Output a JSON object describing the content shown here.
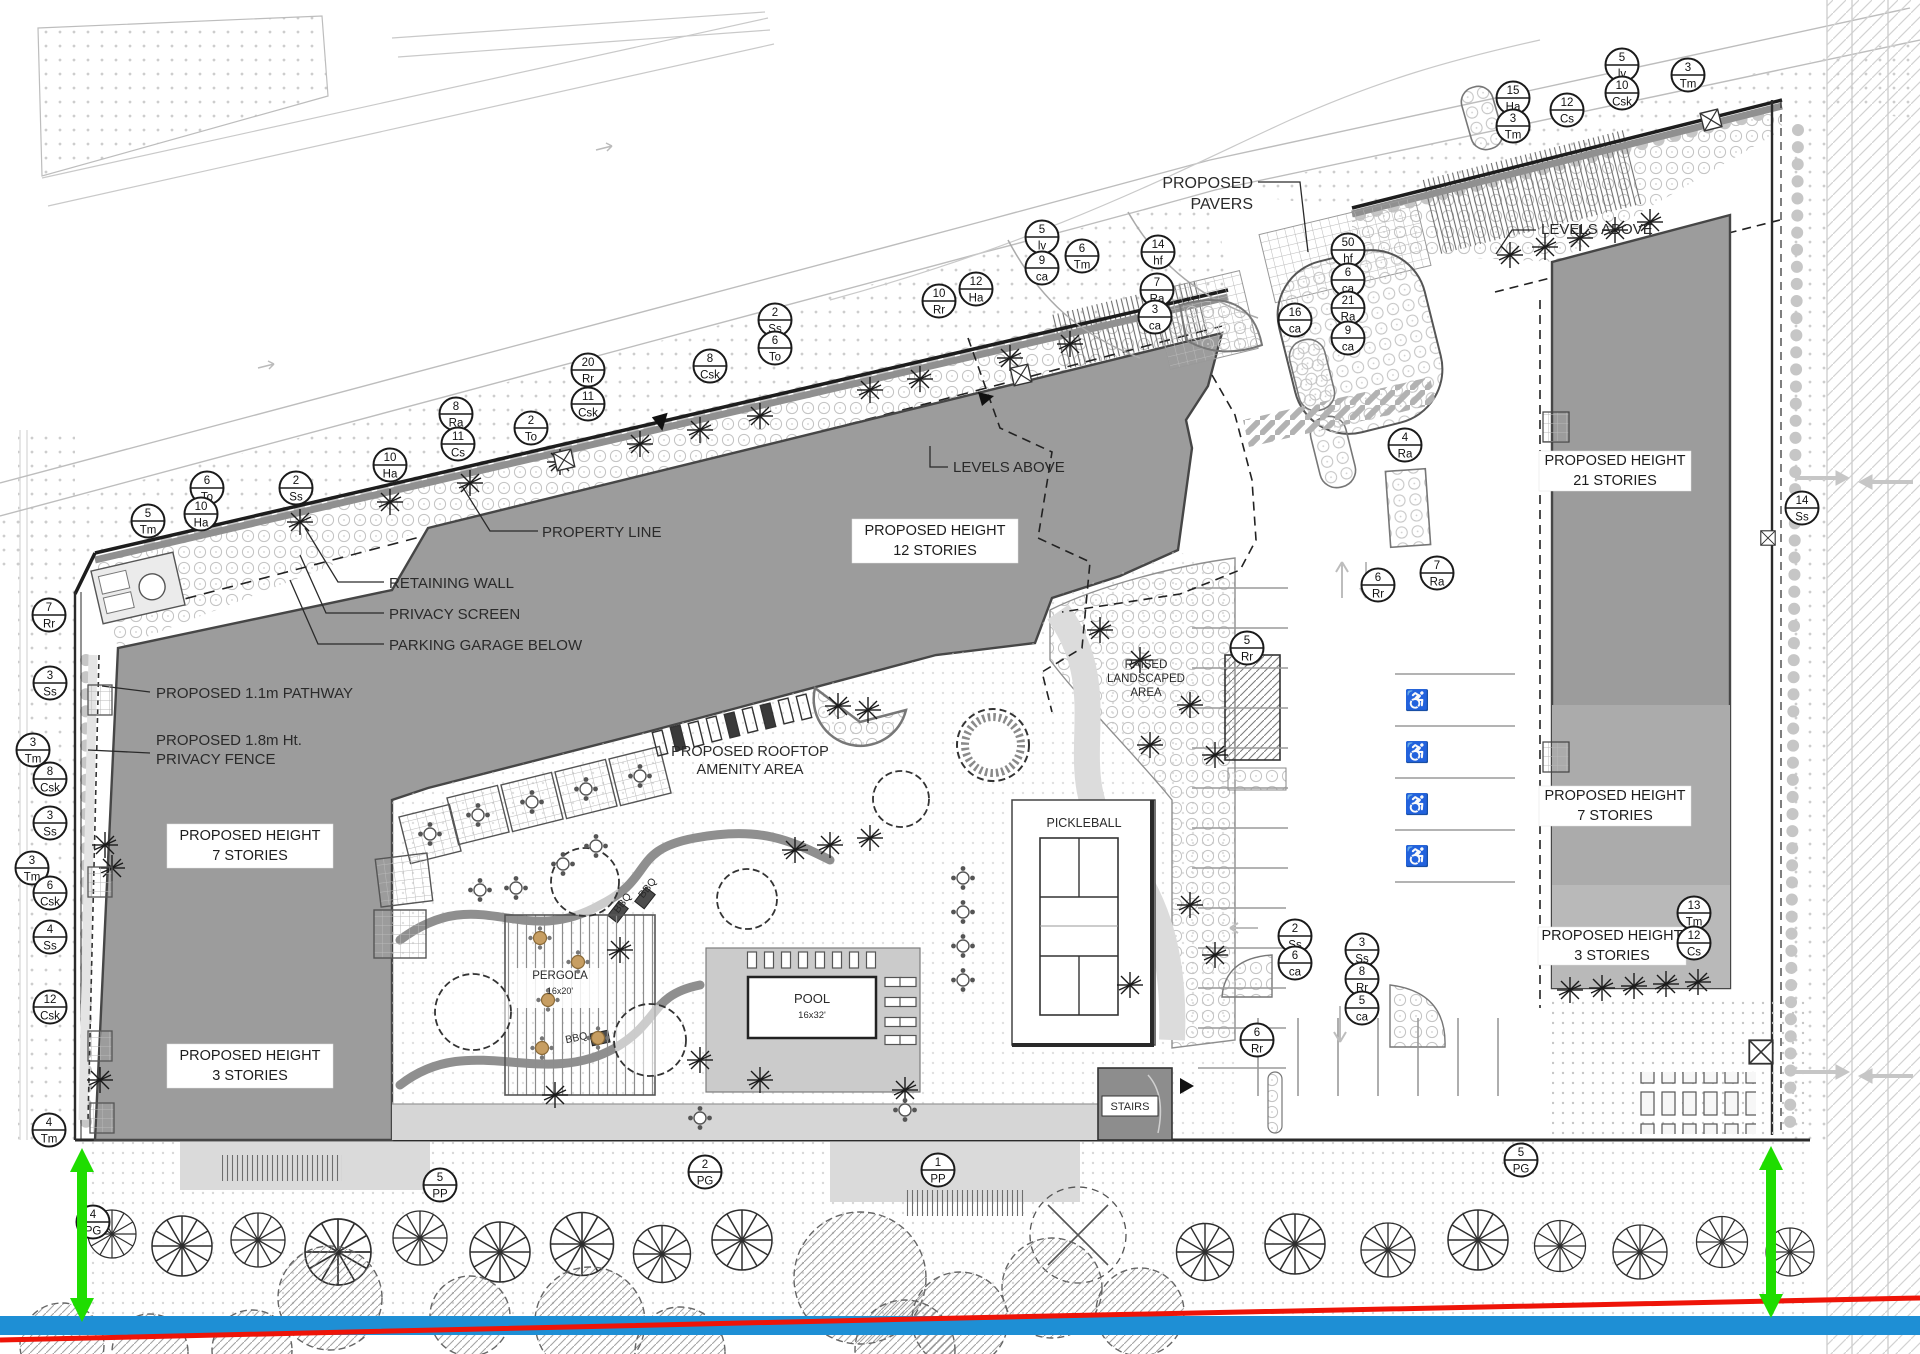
{
  "drawing": {
    "type": "landscape-architecture site plan",
    "colors": {
      "building_dark": "#9c9c9c",
      "building_mid": "#ababab",
      "building_light": "#b9b9b9",
      "deck_gray": "#cbcbcb",
      "walk_gray": "#d6d6d6",
      "line_dark": "#2a2a2a",
      "section_green": "#1fdd00",
      "section_red": "#ee1408",
      "section_blue": "#1e8fd5"
    },
    "labels": [
      {
        "text": "PROPOSED",
        "x": 1253,
        "y": 188,
        "size": 16,
        "anchor": "end"
      },
      {
        "text": "PAVERS",
        "x": 1253,
        "y": 209,
        "size": 16,
        "anchor": "end"
      },
      {
        "text": "LEVELS ABOVE",
        "x": 953,
        "y": 472,
        "size": 15,
        "anchor": "start"
      },
      {
        "text": "LEVELS ABOVE",
        "x": 1541,
        "y": 234,
        "size": 15,
        "anchor": "start"
      },
      {
        "text": "PROPERTY LINE",
        "x": 542,
        "y": 537,
        "size": 15,
        "anchor": "start"
      },
      {
        "text": "RETAINING WALL",
        "x": 389,
        "y": 588,
        "size": 15,
        "anchor": "start"
      },
      {
        "text": "PRIVACY SCREEN",
        "x": 389,
        "y": 619,
        "size": 15,
        "anchor": "start"
      },
      {
        "text": "PARKING GARAGE BELOW",
        "x": 389,
        "y": 650,
        "size": 15,
        "anchor": "start"
      },
      {
        "text": "PROPOSED 1.1m PATHWAY",
        "x": 156,
        "y": 698,
        "size": 15,
        "anchor": "start"
      },
      {
        "text": "PROPOSED 1.8m Ht.",
        "x": 156,
        "y": 745,
        "size": 15,
        "anchor": "start"
      },
      {
        "text": "PRIVACY FENCE",
        "x": 156,
        "y": 764,
        "size": 15,
        "anchor": "start"
      },
      {
        "text": "PROPOSED ROOFTOP",
        "x": 750,
        "y": 756,
        "size": 14.5,
        "anchor": "middle"
      },
      {
        "text": "AMENITY AREA",
        "x": 750,
        "y": 774,
        "size": 14.5,
        "anchor": "middle"
      },
      {
        "text": "RAISED",
        "x": 1146,
        "y": 668,
        "size": 11.5,
        "anchor": "middle"
      },
      {
        "text": "LANDSCAPED",
        "x": 1146,
        "y": 682,
        "size": 11.5,
        "anchor": "middle"
      },
      {
        "text": "AREA",
        "x": 1146,
        "y": 696,
        "size": 11.5,
        "anchor": "middle"
      },
      {
        "text": "PICKLEBALL",
        "x": 1084,
        "y": 827,
        "size": 12.5,
        "anchor": "middle"
      },
      {
        "text": "POOL",
        "x": 812,
        "y": 1003,
        "size": 13,
        "anchor": "middle"
      },
      {
        "text": "16x32'",
        "x": 812,
        "y": 1018,
        "size": 9.5,
        "anchor": "middle"
      },
      {
        "text": "PERGOLA",
        "x": 560,
        "y": 979,
        "size": 11.5,
        "anchor": "middle"
      },
      {
        "text": "16x20'",
        "x": 560,
        "y": 994,
        "size": 9,
        "anchor": "middle"
      },
      {
        "text": "STAIRS",
        "x": 1130,
        "y": 1110,
        "size": 11,
        "anchor": "middle"
      },
      {
        "text": "BBQ",
        "x": 625,
        "y": 905,
        "size": 10.5,
        "anchor": "middle",
        "rot": -52
      },
      {
        "text": "BBQ",
        "x": 650,
        "y": 890,
        "size": 10.5,
        "anchor": "middle",
        "rot": -52
      },
      {
        "text": "BBQ",
        "x": 577,
        "y": 1041,
        "size": 10.5,
        "anchor": "middle",
        "rot": -12
      }
    ],
    "height_boxes": [
      {
        "l1": "PROPOSED HEIGHT",
        "l2": "12 STORIES",
        "x": 935,
        "y": 541,
        "nx": -83,
        "ny": -22,
        "w": 166,
        "h": 44
      },
      {
        "l1": "PROPOSED HEIGHT",
        "l2": "7 STORIES",
        "x": 250,
        "y": 846,
        "nx": -83,
        "ny": -22,
        "w": 166,
        "h": 44
      },
      {
        "l1": "PROPOSED HEIGHT",
        "l2": "3 STORIES",
        "x": 250,
        "y": 1066,
        "nx": -83,
        "ny": -22,
        "w": 166,
        "h": 44
      },
      {
        "l1": "PROPOSED HEIGHT",
        "l2": "21 STORIES",
        "x": 1615,
        "y": 471,
        "nx": -76,
        "ny": -20,
        "w": 152,
        "h": 40
      },
      {
        "l1": "PROPOSED HEIGHT",
        "l2": "7 STORIES",
        "x": 1615,
        "y": 806,
        "nx": -76,
        "ny": -20,
        "w": 152,
        "h": 40
      },
      {
        "l1": "PROPOSED HEIGHT",
        "l2": "3 STORIES",
        "x": 1612,
        "y": 946,
        "nx": -74,
        "ny": -19,
        "w": 148,
        "h": 38
      }
    ],
    "plant_tags": [
      {
        "q": "6",
        "c": "To",
        "x": 207,
        "y": 488
      },
      {
        "q": "10",
        "c": "Ha",
        "x": 201,
        "y": 514
      },
      {
        "q": "5",
        "c": "Tm",
        "x": 148,
        "y": 521
      },
      {
        "q": "2",
        "c": "Ss",
        "x": 296,
        "y": 488
      },
      {
        "q": "10",
        "c": "Ha",
        "x": 390,
        "y": 465
      },
      {
        "q": "8",
        "c": "Ra",
        "x": 456,
        "y": 414
      },
      {
        "q": "11",
        "c": "Cs",
        "x": 458,
        "y": 444
      },
      {
        "q": "2",
        "c": "To",
        "x": 531,
        "y": 428
      },
      {
        "q": "20",
        "c": "Rr",
        "x": 588,
        "y": 370
      },
      {
        "q": "11",
        "c": "Csk",
        "x": 588,
        "y": 404
      },
      {
        "q": "8",
        "c": "Csk",
        "x": 710,
        "y": 366
      },
      {
        "q": "2",
        "c": "Ss",
        "x": 775,
        "y": 320
      },
      {
        "q": "6",
        "c": "To",
        "x": 775,
        "y": 348
      },
      {
        "q": "10",
        "c": "Rr",
        "x": 939,
        "y": 301
      },
      {
        "q": "12",
        "c": "Ha",
        "x": 976,
        "y": 289
      },
      {
        "q": "5",
        "c": "lv",
        "x": 1042,
        "y": 237
      },
      {
        "q": "9",
        "c": "ca",
        "x": 1042,
        "y": 268
      },
      {
        "q": "6",
        "c": "Tm",
        "x": 1082,
        "y": 256
      },
      {
        "q": "14",
        "c": "hf",
        "x": 1158,
        "y": 252
      },
      {
        "q": "7",
        "c": "Ra",
        "x": 1157,
        "y": 290
      },
      {
        "q": "3",
        "c": "ca",
        "x": 1155,
        "y": 317
      },
      {
        "q": "16",
        "c": "ca",
        "x": 1295,
        "y": 320
      },
      {
        "q": "50",
        "c": "hf",
        "x": 1348,
        "y": 250
      },
      {
        "q": "6",
        "c": "ca",
        "x": 1348,
        "y": 280
      },
      {
        "q": "21",
        "c": "Ra",
        "x": 1348,
        "y": 308
      },
      {
        "q": "9",
        "c": "ca",
        "x": 1348,
        "y": 338
      },
      {
        "q": "4",
        "c": "Ra",
        "x": 1405,
        "y": 445
      },
      {
        "q": "15",
        "c": "Ha",
        "x": 1513,
        "y": 98
      },
      {
        "q": "3",
        "c": "Tm",
        "x": 1513,
        "y": 126
      },
      {
        "q": "12",
        "c": "Cs",
        "x": 1567,
        "y": 110
      },
      {
        "q": "5",
        "c": "lv",
        "x": 1622,
        "y": 65
      },
      {
        "q": "10",
        "c": "Csk",
        "x": 1622,
        "y": 93
      },
      {
        "q": "3",
        "c": "Tm",
        "x": 1688,
        "y": 75
      },
      {
        "q": "14",
        "c": "Ss",
        "x": 1802,
        "y": 508
      },
      {
        "q": "7",
        "c": "Ra",
        "x": 1437,
        "y": 573
      },
      {
        "q": "6",
        "c": "Rr",
        "x": 1378,
        "y": 585
      },
      {
        "q": "5",
        "c": "Rr",
        "x": 1247,
        "y": 648
      },
      {
        "q": "2",
        "c": "Ss",
        "x": 1295,
        "y": 936
      },
      {
        "q": "6",
        "c": "ca",
        "x": 1295,
        "y": 963
      },
      {
        "q": "3",
        "c": "Ss",
        "x": 1362,
        "y": 950
      },
      {
        "q": "8",
        "c": "Rr",
        "x": 1362,
        "y": 979
      },
      {
        "q": "5",
        "c": "ca",
        "x": 1362,
        "y": 1008
      },
      {
        "q": "6",
        "c": "Rr",
        "x": 1257,
        "y": 1040
      },
      {
        "q": "13",
        "c": "Tm",
        "x": 1694,
        "y": 913
      },
      {
        "q": "12",
        "c": "Cs",
        "x": 1694,
        "y": 943
      },
      {
        "q": "7",
        "c": "Rr",
        "x": 49,
        "y": 615
      },
      {
        "q": "3",
        "c": "Ss",
        "x": 50,
        "y": 683
      },
      {
        "q": "3",
        "c": "Tm",
        "x": 33,
        "y": 750
      },
      {
        "q": "8",
        "c": "Csk",
        "x": 50,
        "y": 779
      },
      {
        "q": "3",
        "c": "Ss",
        "x": 50,
        "y": 823
      },
      {
        "q": "3",
        "c": "Tm",
        "x": 32,
        "y": 868
      },
      {
        "q": "6",
        "c": "Csk",
        "x": 50,
        "y": 893
      },
      {
        "q": "4",
        "c": "Ss",
        "x": 50,
        "y": 937
      },
      {
        "q": "12",
        "c": "Csk",
        "x": 50,
        "y": 1007
      },
      {
        "q": "4",
        "c": "Tm",
        "x": 49,
        "y": 1130
      },
      {
        "q": "4",
        "c": "PG",
        "x": 93,
        "y": 1222
      },
      {
        "q": "5",
        "c": "PP",
        "x": 440,
        "y": 1185
      },
      {
        "q": "2",
        "c": "PG",
        "x": 705,
        "y": 1172
      },
      {
        "q": "1",
        "c": "PP",
        "x": 938,
        "y": 1170
      },
      {
        "q": "5",
        "c": "PG",
        "x": 1521,
        "y": 1160
      }
    ],
    "trees": [
      {
        "x": 112,
        "y": 1234,
        "s": 0.8
      },
      {
        "x": 182,
        "y": 1246,
        "s": 1
      },
      {
        "x": 258,
        "y": 1240,
        "s": 0.9
      },
      {
        "x": 338,
        "y": 1252,
        "s": 1.1
      },
      {
        "x": 420,
        "y": 1238,
        "s": 0.9
      },
      {
        "x": 500,
        "y": 1252,
        "s": 1
      },
      {
        "x": 582,
        "y": 1244,
        "s": 1.05
      },
      {
        "x": 662,
        "y": 1254,
        "s": 0.95
      },
      {
        "x": 742,
        "y": 1240,
        "s": 1
      },
      {
        "x": 1205,
        "y": 1252,
        "s": 0.95
      },
      {
        "x": 1295,
        "y": 1244,
        "s": 1
      },
      {
        "x": 1388,
        "y": 1250,
        "s": 0.9
      },
      {
        "x": 1478,
        "y": 1240,
        "s": 1
      },
      {
        "x": 1560,
        "y": 1246,
        "s": 0.85
      },
      {
        "x": 1640,
        "y": 1252,
        "s": 0.9
      },
      {
        "x": 1722,
        "y": 1242,
        "s": 0.85
      },
      {
        "x": 1790,
        "y": 1252,
        "s": 0.8
      }
    ],
    "shrubs": [
      {
        "x": 300,
        "y": 522
      },
      {
        "x": 390,
        "y": 502
      },
      {
        "x": 470,
        "y": 483
      },
      {
        "x": 560,
        "y": 462
      },
      {
        "x": 640,
        "y": 444
      },
      {
        "x": 700,
        "y": 430
      },
      {
        "x": 760,
        "y": 416
      },
      {
        "x": 870,
        "y": 390
      },
      {
        "x": 920,
        "y": 379
      },
      {
        "x": 1010,
        "y": 358
      },
      {
        "x": 1070,
        "y": 344
      },
      {
        "x": 1510,
        "y": 255
      },
      {
        "x": 1545,
        "y": 247
      },
      {
        "x": 1580,
        "y": 238
      },
      {
        "x": 1615,
        "y": 230
      },
      {
        "x": 1650,
        "y": 222
      },
      {
        "x": 1570,
        "y": 990
      },
      {
        "x": 1602,
        "y": 988
      },
      {
        "x": 1634,
        "y": 986
      },
      {
        "x": 1666,
        "y": 984
      },
      {
        "x": 1698,
        "y": 982
      },
      {
        "x": 795,
        "y": 850
      },
      {
        "x": 830,
        "y": 845
      },
      {
        "x": 870,
        "y": 838
      },
      {
        "x": 620,
        "y": 950
      },
      {
        "x": 700,
        "y": 1060
      },
      {
        "x": 760,
        "y": 1080
      },
      {
        "x": 555,
        "y": 1095
      },
      {
        "x": 905,
        "y": 1090
      },
      {
        "x": 838,
        "y": 706
      },
      {
        "x": 868,
        "y": 710
      },
      {
        "x": 1100,
        "y": 630
      },
      {
        "x": 1140,
        "y": 660
      },
      {
        "x": 1190,
        "y": 705
      },
      {
        "x": 1215,
        "y": 755
      },
      {
        "x": 1150,
        "y": 745
      },
      {
        "x": 1190,
        "y": 905
      },
      {
        "x": 1215,
        "y": 955
      },
      {
        "x": 1130,
        "y": 985
      },
      {
        "x": 105,
        "y": 845
      },
      {
        "x": 112,
        "y": 868
      },
      {
        "x": 100,
        "y": 1080
      }
    ],
    "blobs": [
      {
        "x": 330,
        "y": 1298,
        "r": 52
      },
      {
        "x": 470,
        "y": 1316,
        "r": 40
      },
      {
        "x": 590,
        "y": 1322,
        "r": 55
      },
      {
        "x": 860,
        "y": 1278,
        "r": 66
      },
      {
        "x": 960,
        "y": 1320,
        "r": 48
      },
      {
        "x": 1052,
        "y": 1288,
        "r": 50
      },
      {
        "x": 1140,
        "y": 1312,
        "r": 44
      },
      {
        "x": 62,
        "y": 1345,
        "r": 42
      },
      {
        "x": 150,
        "y": 1352,
        "r": 38
      },
      {
        "x": 252,
        "y": 1350,
        "r": 40
      },
      {
        "x": 680,
        "y": 1352,
        "r": 45
      },
      {
        "x": 905,
        "y": 1350,
        "r": 50
      }
    ],
    "canopies": [
      {
        "x": 473,
        "y": 1012,
        "r": 38
      },
      {
        "x": 585,
        "y": 882,
        "r": 34
      },
      {
        "x": 650,
        "y": 1040,
        "r": 36
      },
      {
        "x": 747,
        "y": 899,
        "r": 30
      },
      {
        "x": 901,
        "y": 799,
        "r": 28
      }
    ],
    "tables": [
      {
        "x": 478,
        "y": 815
      },
      {
        "x": 532,
        "y": 802
      },
      {
        "x": 586,
        "y": 789
      },
      {
        "x": 640,
        "y": 776
      },
      {
        "x": 430,
        "y": 834
      },
      {
        "x": 596,
        "y": 846
      },
      {
        "x": 563,
        "y": 864
      },
      {
        "x": 480,
        "y": 890
      },
      {
        "x": 516,
        "y": 888
      },
      {
        "x": 963,
        "y": 878
      },
      {
        "x": 963,
        "y": 912
      },
      {
        "x": 963,
        "y": 946
      },
      {
        "x": 963,
        "y": 980
      },
      {
        "x": 905,
        "y": 1110
      },
      {
        "x": 700,
        "y": 1118
      }
    ],
    "pergola_tables": [
      {
        "x": 540,
        "y": 938
      },
      {
        "x": 578,
        "y": 962
      },
      {
        "x": 548,
        "y": 1000
      },
      {
        "x": 542,
        "y": 1048
      },
      {
        "x": 598,
        "y": 1038
      }
    ],
    "chairs": [
      {
        "x": 752,
        "y": 960,
        "rot": 0
      },
      {
        "x": 769,
        "y": 960,
        "rot": 0
      },
      {
        "x": 786,
        "y": 960,
        "rot": 0
      },
      {
        "x": 803,
        "y": 960,
        "rot": 0
      },
      {
        "x": 820,
        "y": 960,
        "rot": 0
      },
      {
        "x": 837,
        "y": 960,
        "rot": 0
      },
      {
        "x": 854,
        "y": 960,
        "rot": 0
      },
      {
        "x": 871,
        "y": 960,
        "rot": 0
      },
      {
        "x": 893,
        "y": 982,
        "rot": 90
      },
      {
        "x": 908,
        "y": 982,
        "rot": 90
      },
      {
        "x": 893,
        "y": 1002,
        "rot": 90
      },
      {
        "x": 908,
        "y": 1002,
        "rot": 90
      },
      {
        "x": 893,
        "y": 1022,
        "rot": 90
      },
      {
        "x": 908,
        "y": 1022,
        "rot": 90
      },
      {
        "x": 893,
        "y": 1040,
        "rot": 90
      },
      {
        "x": 908,
        "y": 1040,
        "rot": 90
      }
    ],
    "roof_units": [
      {
        "x": 660,
        "y": 743,
        "fill": "none"
      },
      {
        "x": 678,
        "y": 738,
        "fill": "#3a3a3a"
      },
      {
        "x": 696,
        "y": 734,
        "fill": "none"
      },
      {
        "x": 714,
        "y": 729,
        "fill": "none"
      },
      {
        "x": 732,
        "y": 725,
        "fill": "#3a3a3a"
      },
      {
        "x": 750,
        "y": 720,
        "fill": "none"
      },
      {
        "x": 768,
        "y": 716,
        "fill": "#3a3a3a"
      },
      {
        "x": 786,
        "y": 711,
        "fill": "none"
      },
      {
        "x": 804,
        "y": 707,
        "fill": "none"
      }
    ],
    "terrace_squares": [
      {
        "x": 478,
        "y": 815,
        "rot": -14
      },
      {
        "x": 532,
        "y": 802,
        "rot": -14
      },
      {
        "x": 586,
        "y": 789,
        "rot": -14
      },
      {
        "x": 640,
        "y": 776,
        "rot": -14
      },
      {
        "x": 430,
        "y": 834,
        "rot": -14
      },
      {
        "x": 404,
        "y": 880,
        "rot": -7
      },
      {
        "x": 400,
        "y": 934,
        "rot": 0
      }
    ],
    "planters": [
      {
        "x": 100,
        "y": 700
      },
      {
        "x": 100,
        "y": 882
      },
      {
        "x": 100,
        "y": 1046
      },
      {
        "x": 102,
        "y": 1118
      }
    ],
    "wheelchairs": [
      {
        "x": 1417,
        "y": 700,
        "t": "♿"
      },
      {
        "x": 1417,
        "y": 752,
        "t": "♿"
      },
      {
        "x": 1417,
        "y": 804,
        "t": "♿"
      },
      {
        "x": 1417,
        "y": 856,
        "t": "♿"
      }
    ],
    "xmarks": [
      {
        "x": 564,
        "y": 460,
        "rot": -13,
        "s": 1
      },
      {
        "x": 1021,
        "y": 375,
        "rot": -13,
        "s": 1
      },
      {
        "x": 1711,
        "y": 120,
        "rot": -14,
        "s": 1
      },
      {
        "x": 1768,
        "y": 538,
        "rot": 0,
        "s": 0.8
      },
      {
        "x": 1761,
        "y": 1052,
        "rot": 0,
        "s": 1.3
      }
    ]
  }
}
